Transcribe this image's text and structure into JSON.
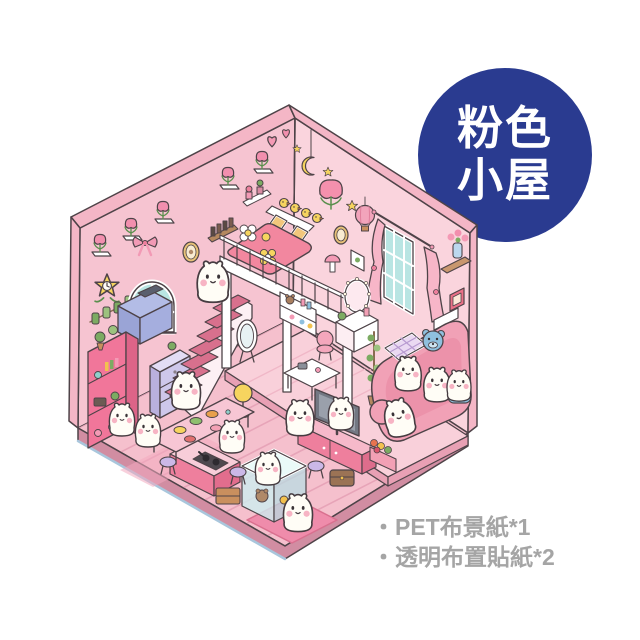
{
  "canvas": {
    "background_color": "#ffffff",
    "width": 640,
    "height": 640
  },
  "badge": {
    "shape": "circle",
    "bg_color": "#2a3b90",
    "text_color": "#ffffff",
    "text_lines": [
      "粉色",
      "小屋"
    ]
  },
  "notes": {
    "text_color": "#a5a5a5",
    "items": [
      "・PET布景紙*1",
      "・透明布置貼紙*2"
    ]
  },
  "illustration": {
    "alt": "isometric pink miniature dollhouse room with loft bed, pink stairs, sofa, TV and white puppy characters",
    "palette": {
      "wall_left": "#f6c4d1",
      "wall_right": "#fad4dd",
      "roof_edge": "#f4b6c6",
      "floor": "#f5c0cd",
      "floor_edge": "#d18da2",
      "hot_pink_furniture": "#ee7f9d",
      "glass_teal": "#b9e5e3",
      "accent_yellow": "#f6d45f",
      "lavender": "#cec7ea",
      "character_white": "#fffdf6",
      "outline": "#4e4348"
    }
  }
}
